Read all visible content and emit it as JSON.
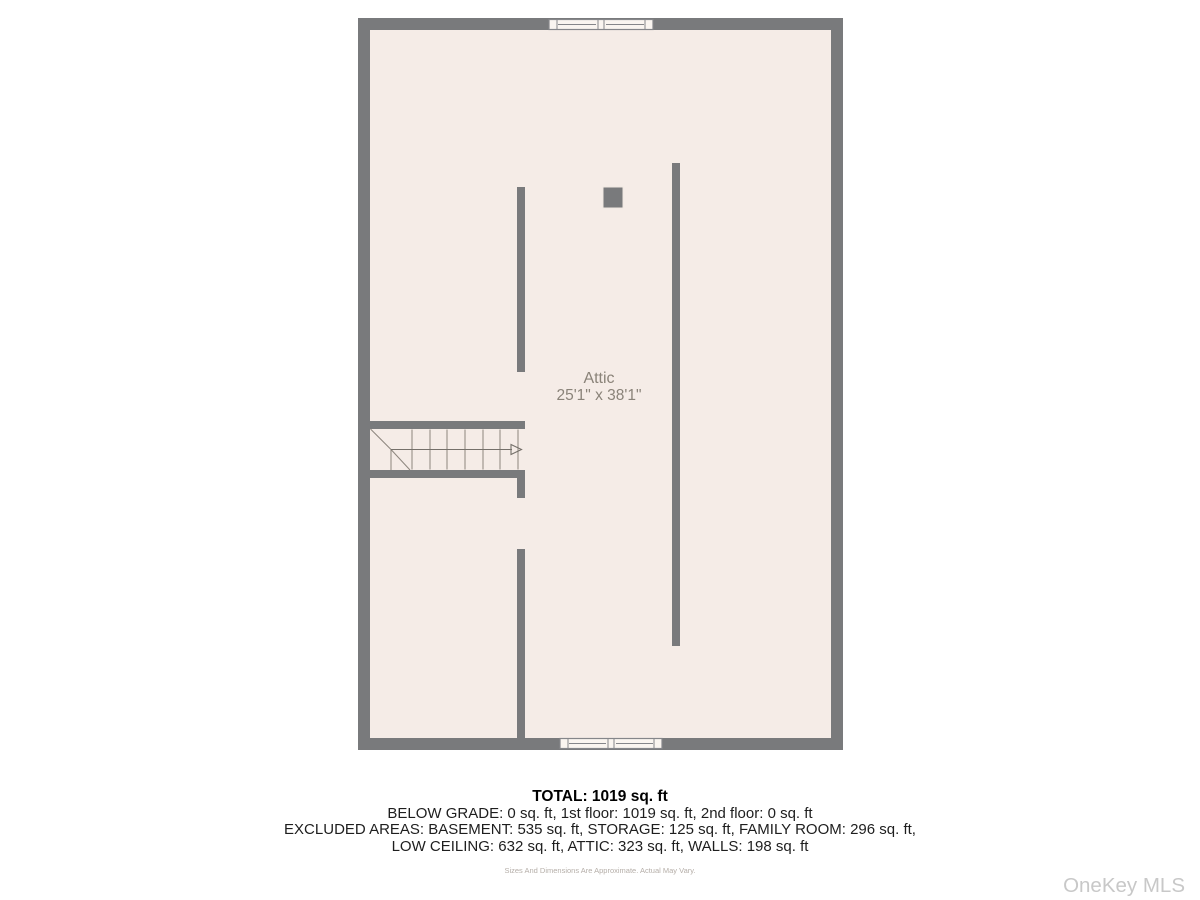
{
  "floor_plan": {
    "room": {
      "label": "Attic",
      "dimensions": "25'1\" x 38'1\""
    },
    "colors": {
      "wall": "#797a7c",
      "floor": "#f5ece7",
      "window_frame": "#faf5f0",
      "stair_lines": "#8d867e",
      "room_label_text": "#8a8379"
    }
  },
  "footer": {
    "total": "TOTAL: 1019 sq. ft",
    "breakdown_line1": "BELOW GRADE: 0 sq. ft, 1st floor: 1019 sq. ft, 2nd floor: 0 sq. ft",
    "breakdown_line2": "EXCLUDED AREAS: BASEMENT: 535 sq. ft, STORAGE: 125 sq. ft, FAMILY ROOM: 296 sq. ft,",
    "breakdown_line3": "LOW CEILING: 632 sq. ft, ATTIC: 323 sq. ft, WALLS: 198 sq. ft",
    "disclaimer": "Sizes And Dimensions Are Approximate. Actual May Vary."
  },
  "watermark": "OneKey MLS"
}
